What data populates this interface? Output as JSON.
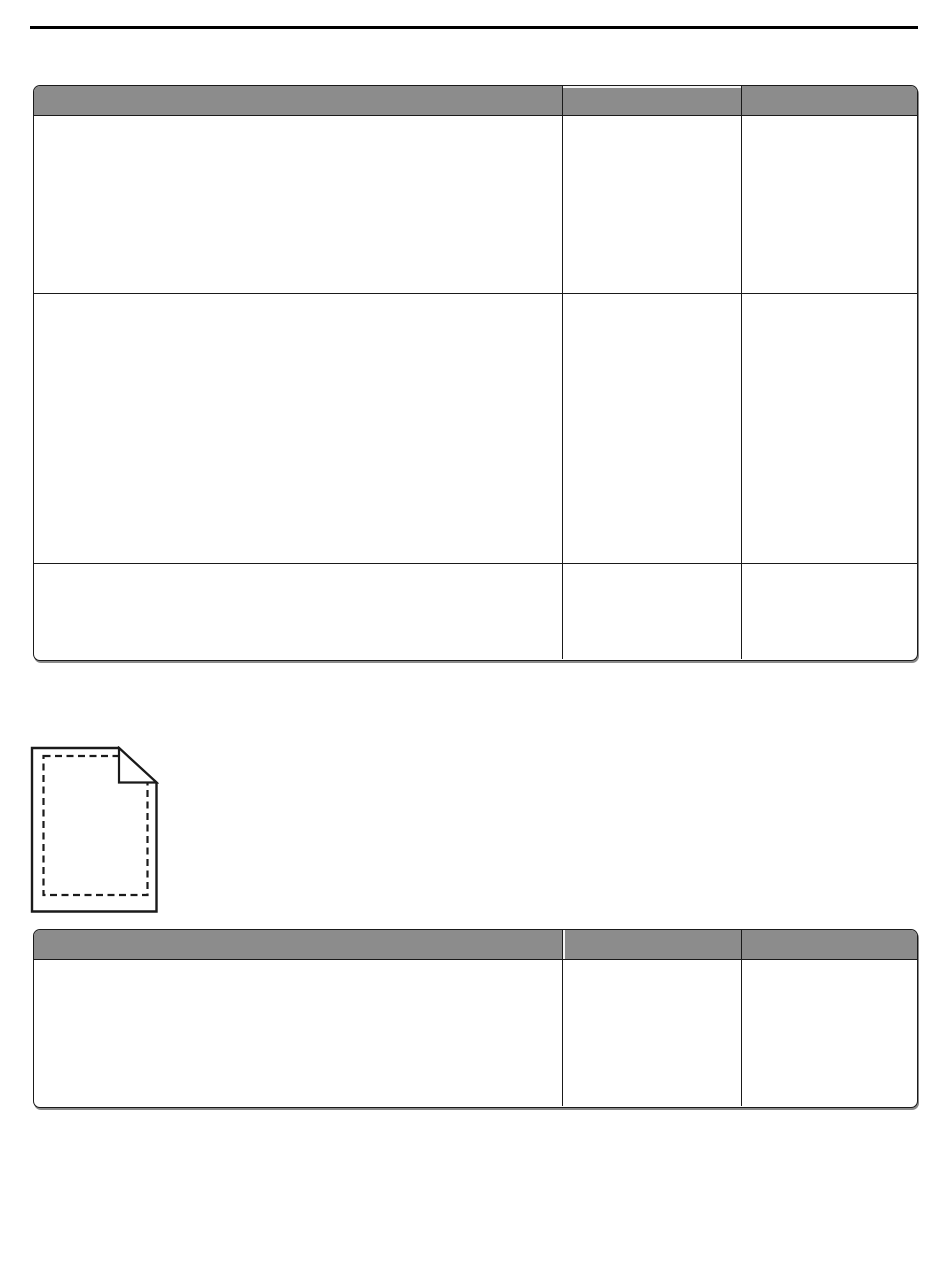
{
  "colors": {
    "page_background": "#ffffff",
    "top_rule": "#000000",
    "table_header_background": "#8c8c8c",
    "table_border": "#1a1a1a",
    "link_underline": "#000080",
    "table_shadow": "#8a8a8a"
  },
  "tables": [
    {
      "id": "table-1",
      "columns": 3,
      "header_cells": [
        "",
        "",
        ""
      ],
      "rows": [
        [
          "",
          "",
          ""
        ],
        [
          "",
          "",
          ""
        ],
        [
          "",
          "",
          ""
        ]
      ],
      "link": {
        "text": "",
        "underline_lines": 2,
        "color": "#000080"
      }
    },
    {
      "id": "table-2",
      "columns": 3,
      "header_cells": [
        "",
        "",
        ""
      ],
      "rows": [
        [
          "",
          "",
          ""
        ]
      ]
    }
  ],
  "icons": {
    "page_icon": "dog-eared-page-with-dashed-margins"
  }
}
